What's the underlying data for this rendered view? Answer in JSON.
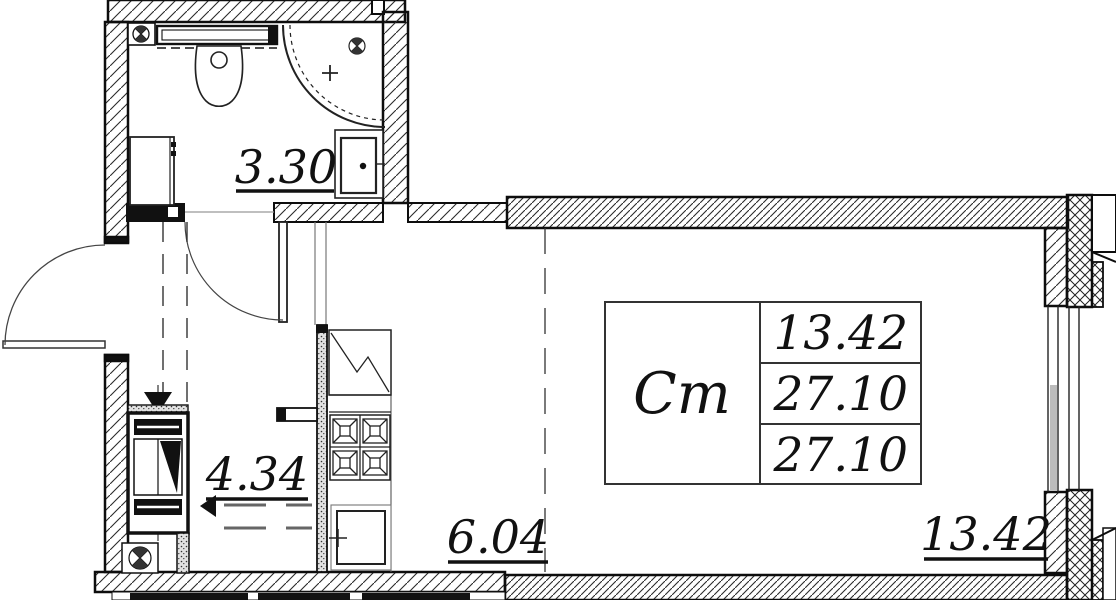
{
  "plan": {
    "rooms": [
      {
        "id": "bathroom",
        "area": "3.30"
      },
      {
        "id": "hallway",
        "area": "4.34"
      },
      {
        "id": "kitchen-zone",
        "area": "6.04"
      },
      {
        "id": "living-zone",
        "area": "13.42"
      }
    ],
    "info_table": {
      "apartment_type": "Ст",
      "living_area": "13.42",
      "area_without_balcony": "27.10",
      "total_area": "27.10"
    },
    "colors": {
      "line": "#111111",
      "background": "#ffffff",
      "dash": "#555555",
      "glass_shade": "#bcbcbc"
    }
  }
}
